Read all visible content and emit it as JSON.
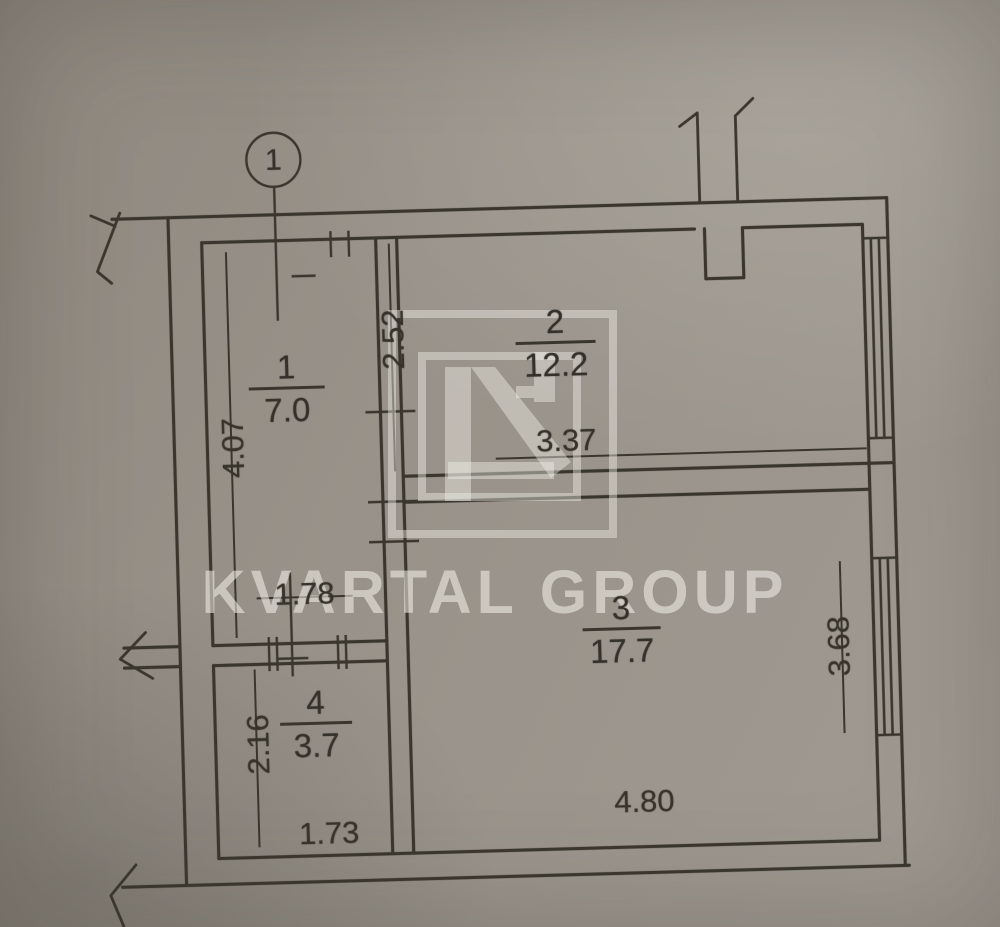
{
  "plan": {
    "axis_marker": "1",
    "rooms": [
      {
        "number": "1",
        "area": "7.0"
      },
      {
        "number": "2",
        "area": "12.2"
      },
      {
        "number": "3",
        "area": "17.7"
      },
      {
        "number": "4",
        "area": "3.7"
      }
    ],
    "dimensions": {
      "room1_height": "4.07",
      "room1_width": "1.78",
      "room2_height": "2.52",
      "room2_width": "3.37",
      "room3_height": "3.68",
      "room3_width": "4.80",
      "room4_height": "2.16",
      "room4_width": "1.73"
    }
  },
  "watermark": {
    "brand": "KVARTAL GROUP"
  },
  "colors": {
    "paper": "#98928a",
    "ink": "#3a362e",
    "watermark": "#f6f3eb"
  }
}
